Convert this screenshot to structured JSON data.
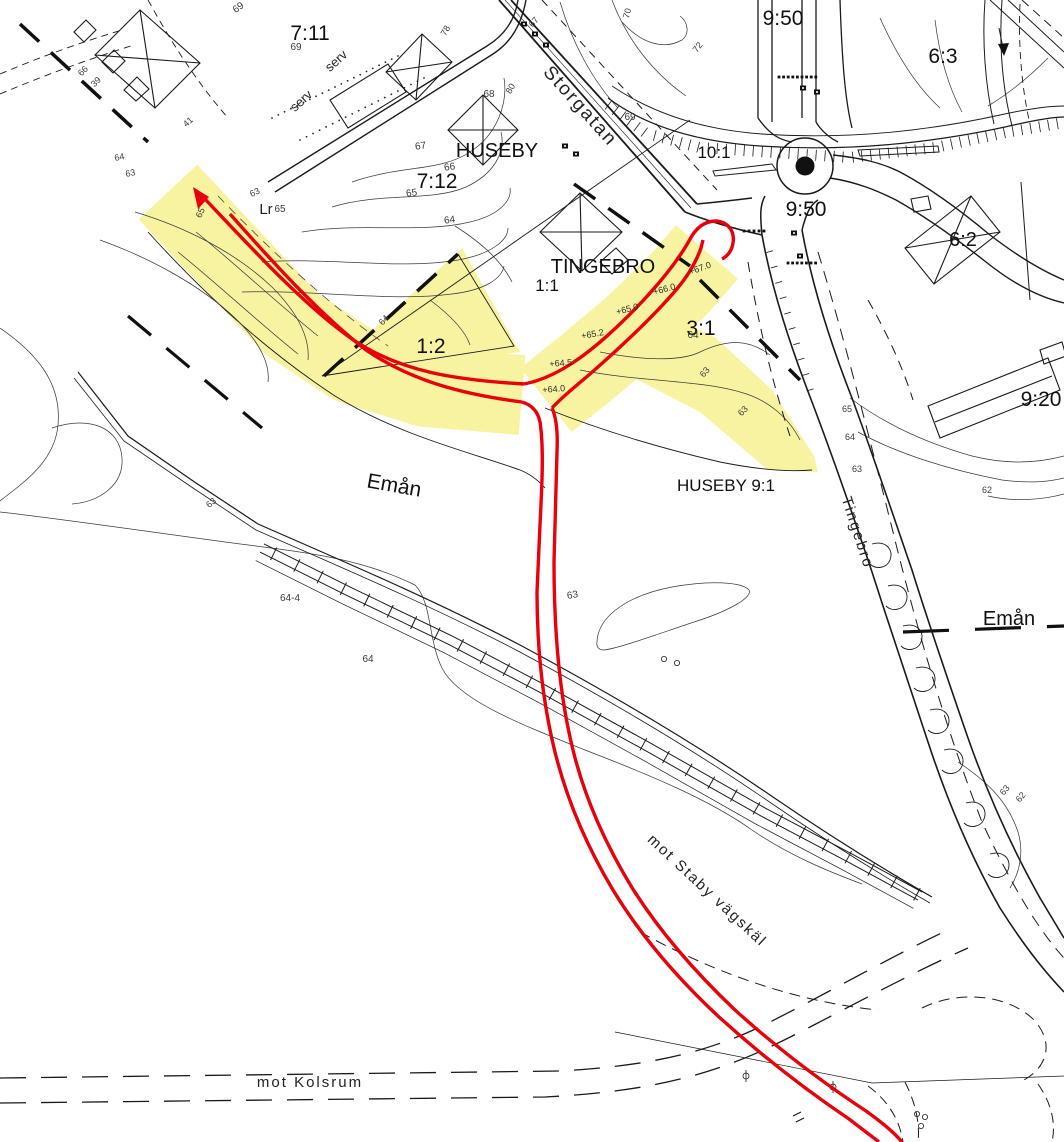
{
  "colors": {
    "background": "#ffffff",
    "linework": "#1a1a1a",
    "contour_lines": "#3c3c3c",
    "route_red": "#e8000b",
    "highlight_yellow": "#f7f3a1"
  },
  "map_labels": [
    {
      "t": "7:11",
      "x": 310,
      "y": 40,
      "s": 21,
      "r": 0,
      "c": "parcel"
    },
    {
      "t": "7:12",
      "x": 437,
      "y": 188,
      "s": 21,
      "r": 0,
      "c": "parcel"
    },
    {
      "t": "1:1",
      "x": 547,
      "y": 291,
      "s": 17,
      "r": 0,
      "c": "parcel"
    },
    {
      "t": "1:2",
      "x": 431,
      "y": 353,
      "s": 21,
      "r": 0,
      "c": "parcel"
    },
    {
      "t": "3:1",
      "x": 701,
      "y": 335,
      "s": 21,
      "r": 0,
      "c": "parcel"
    },
    {
      "t": "10:1",
      "x": 714,
      "y": 158,
      "s": 17,
      "r": 0,
      "c": "parcel"
    },
    {
      "t": "9:50",
      "x": 806,
      "y": 216,
      "s": 21,
      "r": 0,
      "c": "parcel"
    },
    {
      "t": "9:50",
      "x": 783,
      "y": 25,
      "s": 21,
      "r": 0,
      "c": "parcel"
    },
    {
      "t": "6:3",
      "x": 943,
      "y": 63,
      "s": 21,
      "r": 0,
      "c": "parcel"
    },
    {
      "t": "6:2",
      "x": 963,
      "y": 246,
      "s": 20,
      "r": 0,
      "c": "parcel"
    },
    {
      "t": "9:20",
      "x": 1041,
      "y": 406,
      "s": 21,
      "r": 0,
      "c": "parcel"
    },
    {
      "t": "HUSEBY",
      "x": 497,
      "y": 157,
      "s": 20,
      "r": 0,
      "c": "place"
    },
    {
      "t": "TINGEBRO",
      "x": 603,
      "y": 273,
      "s": 20,
      "r": 0,
      "c": "place"
    },
    {
      "t": "HUSEBY 9:1",
      "x": 726,
      "y": 491,
      "s": 17,
      "r": 0,
      "c": "place"
    },
    {
      "t": "Emån",
      "x": 393,
      "y": 492,
      "s": 21,
      "r": 10,
      "c": "place"
    },
    {
      "t": "Emån",
      "x": 1009,
      "y": 625,
      "s": 20,
      "r": 0,
      "c": "place"
    },
    {
      "t": "Storgatan",
      "x": 576,
      "y": 110,
      "s": 19,
      "r": 48,
      "c": "road"
    },
    {
      "t": "Tingebro",
      "x": 853,
      "y": 534,
      "s": 15,
      "r": 72,
      "c": "road"
    },
    {
      "t": "mot Kolsrum",
      "x": 310,
      "y": 1087,
      "s": 15,
      "r": 0,
      "c": "road"
    },
    {
      "t": "mot Staby vägskäl",
      "x": 704,
      "y": 894,
      "s": 15,
      "r": 43,
      "c": "road"
    },
    {
      "t": "serv",
      "x": 339,
      "y": 64,
      "s": 13,
      "r": -42,
      "c": "small"
    },
    {
      "t": "serv",
      "x": 304,
      "y": 104,
      "s": 13,
      "r": -42,
      "c": "small"
    },
    {
      "t": "Lr",
      "x": 266,
      "y": 214,
      "s": 15,
      "r": 0,
      "c": "small"
    },
    {
      "t": "+67.0",
      "x": 701,
      "y": 271,
      "s": 9,
      "r": -20,
      "c": "level"
    },
    {
      "t": "+66.0",
      "x": 665,
      "y": 292,
      "s": 9,
      "r": -15,
      "c": "level"
    },
    {
      "t": "+65.0",
      "x": 628,
      "y": 312,
      "s": 9,
      "r": -15,
      "c": "level"
    },
    {
      "t": "+65.2",
      "x": 593,
      "y": 337,
      "s": 9,
      "r": -10,
      "c": "level"
    },
    {
      "t": "+64.5",
      "x": 561,
      "y": 366,
      "s": 9,
      "r": -5,
      "c": "level"
    },
    {
      "t": "+64.0",
      "x": 554,
      "y": 392,
      "s": 9,
      "r": -5,
      "c": "level"
    },
    {
      "t": "69",
      "x": 296,
      "y": 50,
      "s": 10,
      "r": 0,
      "c": "contour"
    },
    {
      "t": "69",
      "x": 240,
      "y": 10,
      "s": 10,
      "r": -35,
      "c": "contour"
    },
    {
      "t": "66",
      "x": 85,
      "y": 73,
      "s": 9,
      "r": -45,
      "c": "contour"
    },
    {
      "t": "39",
      "x": 98,
      "y": 84,
      "s": 9,
      "r": -45,
      "c": "contour"
    },
    {
      "t": "41",
      "x": 190,
      "y": 124,
      "s": 9,
      "r": -42,
      "c": "contour"
    },
    {
      "t": "64",
      "x": 120,
      "y": 160,
      "s": 9,
      "r": -12,
      "c": "contour"
    },
    {
      "t": "63",
      "x": 131,
      "y": 176,
      "s": 9,
      "r": -12,
      "c": "contour"
    },
    {
      "t": "78",
      "x": 448,
      "y": 32,
      "s": 9,
      "r": -60,
      "c": "contour"
    },
    {
      "t": "80",
      "x": 513,
      "y": 90,
      "s": 9,
      "r": -60,
      "c": "contour"
    },
    {
      "t": "67",
      "x": 536,
      "y": 24,
      "s": 9,
      "r": -50,
      "c": "contour"
    },
    {
      "t": "68",
      "x": 489,
      "y": 97,
      "s": 10,
      "r": 0,
      "c": "contour"
    },
    {
      "t": "67",
      "x": 421,
      "y": 149,
      "s": 10,
      "r": -8,
      "c": "contour"
    },
    {
      "t": "66",
      "x": 450,
      "y": 170,
      "s": 10,
      "r": -8,
      "c": "contour"
    },
    {
      "t": "65",
      "x": 412,
      "y": 196,
      "s": 10,
      "r": -8,
      "c": "contour"
    },
    {
      "t": "64",
      "x": 450,
      "y": 223,
      "s": 10,
      "r": -8,
      "c": "contour"
    },
    {
      "t": "70",
      "x": 630,
      "y": 14,
      "s": 9,
      "r": -75,
      "c": "contour"
    },
    {
      "t": "72",
      "x": 700,
      "y": 49,
      "s": 9,
      "r": -52,
      "c": "contour"
    },
    {
      "t": "69",
      "x": 630,
      "y": 120,
      "s": 10,
      "r": 0,
      "c": "contour"
    },
    {
      "t": "63",
      "x": 256,
      "y": 195,
      "s": 9,
      "r": -25,
      "c": "contour"
    },
    {
      "t": "65",
      "x": 280,
      "y": 212,
      "s": 10,
      "r": 0,
      "c": "contour"
    },
    {
      "t": "65",
      "x": 203,
      "y": 214,
      "s": 9,
      "r": -65,
      "c": "contour"
    },
    {
      "t": "64",
      "x": 386,
      "y": 322,
      "s": 9,
      "r": -48,
      "c": "contour"
    },
    {
      "t": "64",
      "x": 693,
      "y": 338,
      "s": 10,
      "r": 0,
      "c": "contour"
    },
    {
      "t": "63",
      "x": 707,
      "y": 374,
      "s": 9,
      "r": -50,
      "c": "contour"
    },
    {
      "t": "63",
      "x": 745,
      "y": 413,
      "s": 9,
      "r": -45,
      "c": "contour"
    },
    {
      "t": "63",
      "x": 213,
      "y": 505,
      "s": 9,
      "r": -40,
      "c": "contour"
    },
    {
      "t": "64-4",
      "x": 290,
      "y": 601,
      "s": 10,
      "r": 0,
      "c": "contour"
    },
    {
      "t": "64",
      "x": 368,
      "y": 662,
      "s": 10,
      "r": 0,
      "c": "contour"
    },
    {
      "t": "63",
      "x": 573,
      "y": 598,
      "s": 10,
      "r": -10,
      "c": "contour"
    },
    {
      "t": "65",
      "x": 847,
      "y": 412,
      "s": 9,
      "r": 0,
      "c": "contour"
    },
    {
      "t": "64",
      "x": 850,
      "y": 440,
      "s": 9,
      "r": 0,
      "c": "contour"
    },
    {
      "t": "63",
      "x": 857,
      "y": 472,
      "s": 9,
      "r": 0,
      "c": "contour"
    },
    {
      "t": "62",
      "x": 987,
      "y": 493,
      "s": 9,
      "r": 0,
      "c": "contour"
    },
    {
      "t": "63",
      "x": 1007,
      "y": 792,
      "s": 9,
      "r": -50,
      "c": "contour"
    },
    {
      "t": "62",
      "x": 1023,
      "y": 799,
      "s": 9,
      "r": -50,
      "c": "contour"
    }
  ]
}
